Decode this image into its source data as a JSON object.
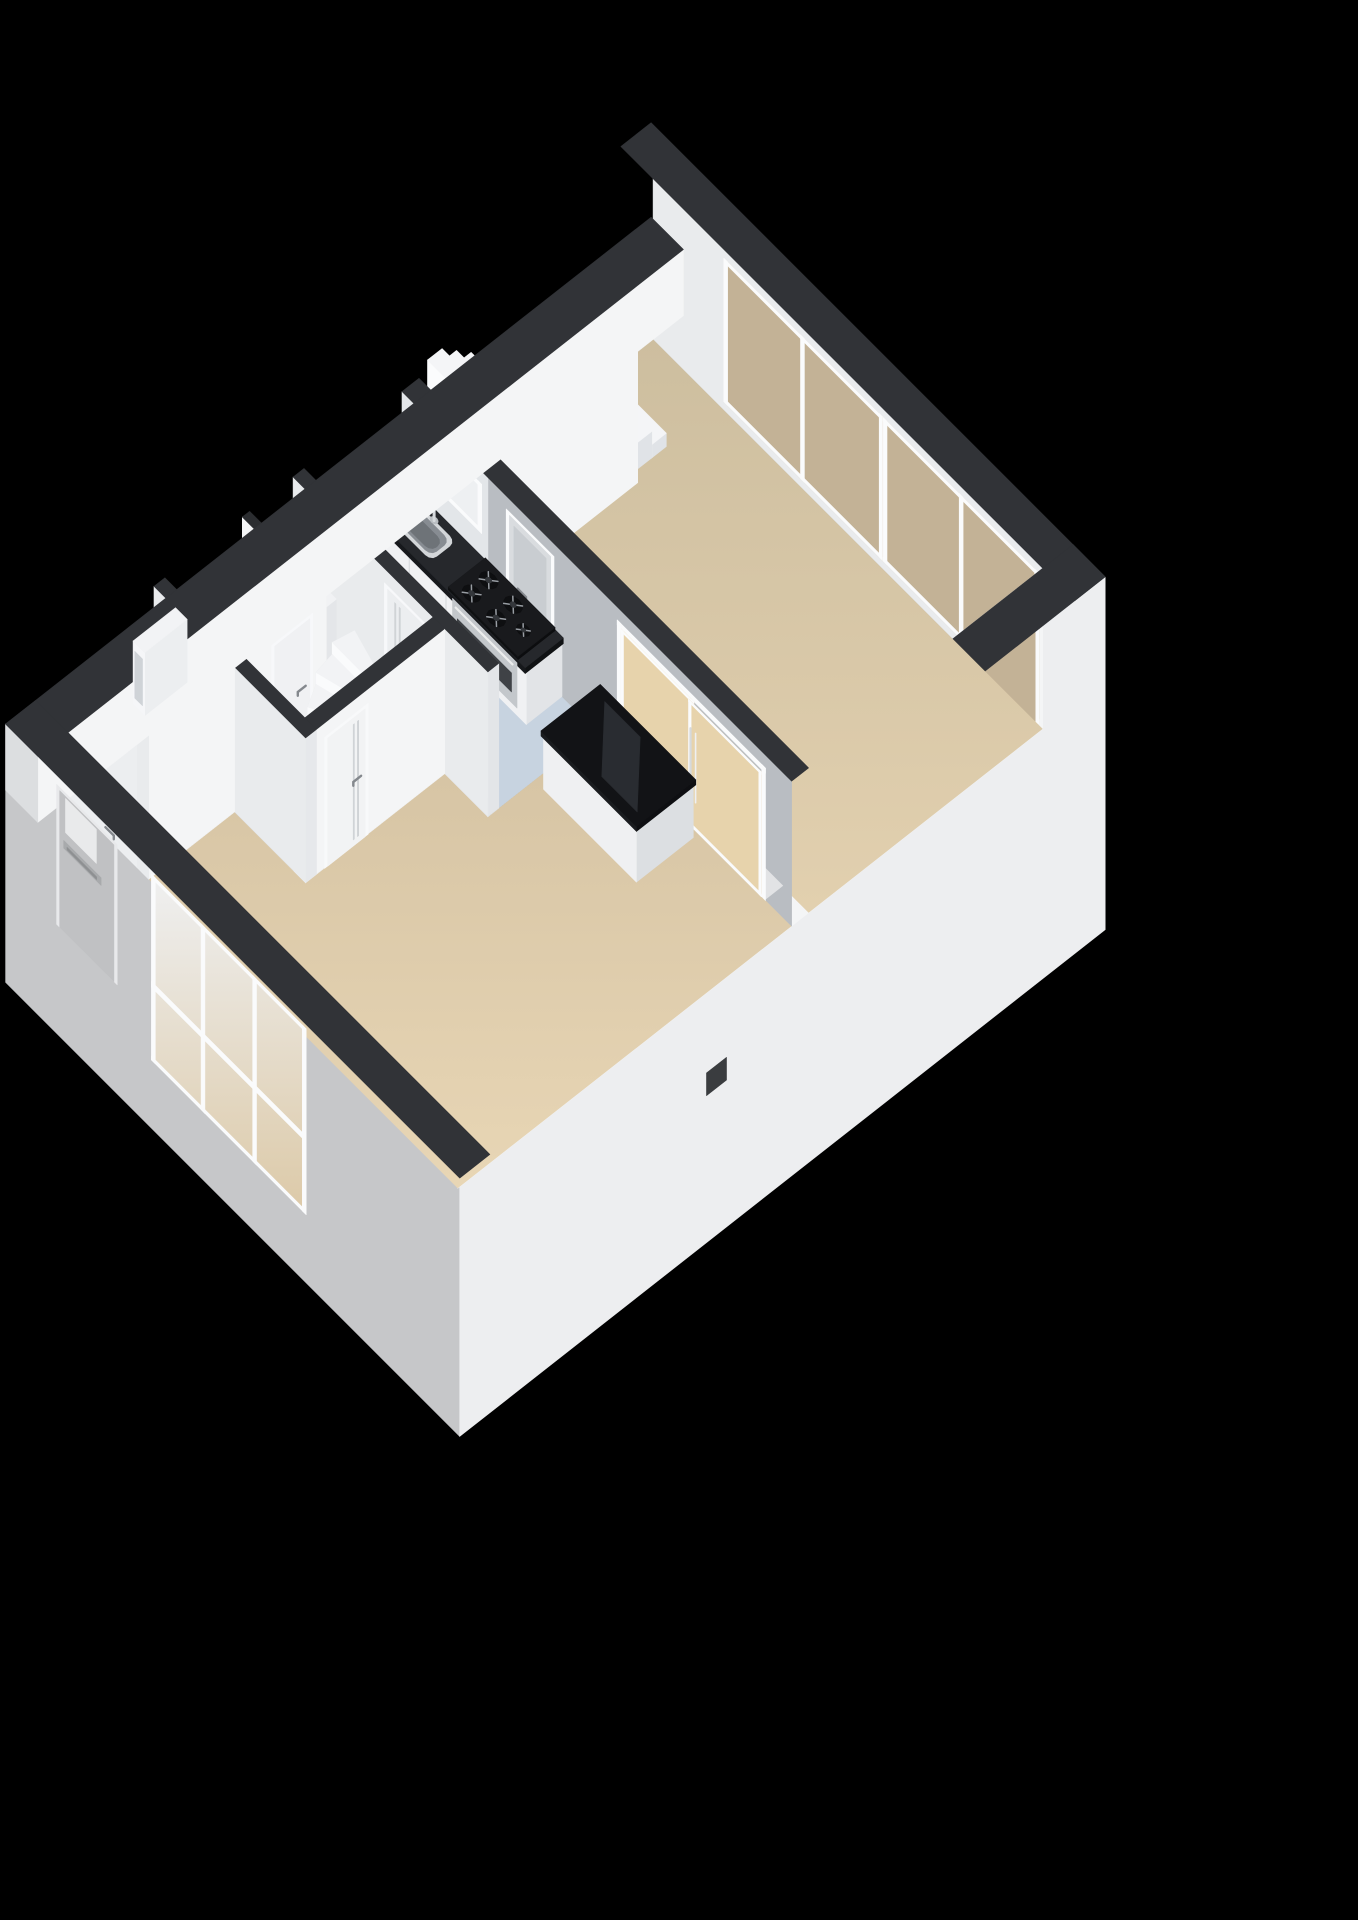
{
  "meta": {
    "kind": "3d-isometric-floorplan-render",
    "level_text": ""
  },
  "canvas": {
    "width": 1358,
    "height": 1920
  },
  "colors": {
    "bg": "#000000",
    "capDark": "#313337",
    "capDark2": "#2b2d30",
    "facadeSW": "#c6c7c9",
    "facadeSE": "#edeef0",
    "wallWhite": "#f4f5f6",
    "wallLight": "#e9ebed",
    "wallGray": "#b9bdc2",
    "wallSoft": "#e3e6e9",
    "floorBlue": "#c7d3e0",
    "floorHall": "#eceef0",
    "floorWC": "#f1f2f4",
    "glassTan": "#c3b296",
    "glassBeige": "#e7d3ac",
    "glassWhite": "#eef0f2",
    "frameWhite": "#fafbfc",
    "counterTop": "#26282c",
    "steel": "#c3c7cb",
    "black": "#121316",
    "chrome": "#d6d9dc",
    "meterAccent": "#c25a2e",
    "floorBeigeDark": "#cfc0a1",
    "floorBeigeLight": "#e5d3b2"
  },
  "projection": {
    "origin": [
      652,
      308
    ],
    "eu": [
      64.5,
      64.5
    ],
    "ev": [
      -60.5,
      47.5
    ],
    "ez": 63
  },
  "gradients": [
    {
      "id": "gBeige1",
      "from": "#cdbe9f",
      "to": "#e2d0af"
    },
    {
      "id": "gBeige2",
      "from": "#d5c3a3",
      "to": "#e8d6b5"
    },
    {
      "id": "gFrontGlass",
      "from": "#eff0f1",
      "to": "#dcc9a7"
    }
  ],
  "scene": [
    {
      "t": "face",
      "name": "facade-sw",
      "plane": "v",
      "c": 10.45,
      "a1": -0.22,
      "a2": 6.82,
      "z1": -3.05,
      "z2": 1.05,
      "fill": "facadeSW"
    },
    {
      "t": "face",
      "name": "facade-se",
      "plane": "u",
      "c": 6.82,
      "a1": -0.22,
      "a2": 10.45,
      "z1": -3.05,
      "z2": 2.55,
      "fill": "facadeSE"
    },
    {
      "t": "face",
      "name": "facade-vent",
      "plane": "u",
      "c": 6.83,
      "a1": 6.05,
      "a2": 6.38,
      "z1": -0.7,
      "z2": -0.34,
      "fill": "#3a3c3f"
    },
    {
      "t": "face",
      "name": "ne-wall-inner",
      "plane": "v",
      "c": 0.28,
      "a1": 0.28,
      "a2": 6.32,
      "z1": 0,
      "z2": 2.55,
      "fill": "wallLight"
    },
    {
      "t": "window",
      "name": "ne-window-left",
      "plane": "v",
      "c": 0.285,
      "a1": 1.38,
      "a2": 3.85,
      "z1": 0.14,
      "z2": 2.42,
      "divs": [
        2.6
      ],
      "rails": [],
      "glass": "glassTan",
      "frame": "frameWhite"
    },
    {
      "t": "window",
      "name": "ne-window-right",
      "plane": "v",
      "c": 0.285,
      "a1": 3.85,
      "a2": 6.26,
      "z1": 0.14,
      "z2": 2.42,
      "divs": [
        5.06
      ],
      "rails": [],
      "glass": "glassTan",
      "frame": "frameWhite"
    },
    {
      "t": "top",
      "name": "ne-wall-cap",
      "u1": -0.22,
      "v1": -0.22,
      "u2": 6.82,
      "v2": 0.28,
      "z": 2.55,
      "fill": "capDark"
    },
    {
      "t": "face",
      "name": "se-wall-inner",
      "plane": "u",
      "c": 6.32,
      "a1": 0.28,
      "a2": 9.95,
      "z1": 0,
      "z2": 2.55,
      "fill": "wallWhite"
    },
    {
      "t": "window",
      "name": "se-window",
      "plane": "u",
      "c": 6.325,
      "a1": 0.34,
      "a2": 2.25,
      "z1": 0.14,
      "z2": 2.42,
      "divs": [
        1.28
      ],
      "rails": [],
      "glass": "glassTan",
      "frame": "frameWhite"
    },
    {
      "t": "top",
      "name": "se-wall-cap",
      "u1": 6.32,
      "v1": -0.22,
      "u2": 6.82,
      "v2": 10.45,
      "z": 2.55,
      "fill": "capDark"
    },
    {
      "t": "floor",
      "name": "floor-living-upper",
      "pts": [
        [
          0.28,
          0.28
        ],
        [
          6.32,
          0.28
        ],
        [
          6.32,
          4.15
        ],
        [
          0.28,
          4.15
        ]
      ],
      "fill": "url:gBeige1"
    },
    {
      "t": "floor",
      "name": "floor-kitchen",
      "pts": [
        [
          0.28,
          4.43
        ],
        [
          3.3,
          4.43
        ],
        [
          3.3,
          6.05
        ],
        [
          0.28,
          6.05
        ]
      ],
      "fill": "floorBlue"
    },
    {
      "t": "floor",
      "name": "floor-living-lower",
      "pts": [
        [
          3.3,
          4.43
        ],
        [
          6.32,
          4.43
        ],
        [
          6.32,
          9.95
        ],
        [
          1.53,
          9.95
        ],
        [
          1.53,
          8.53
        ],
        [
          2.63,
          8.53
        ],
        [
          2.63,
          6.23
        ],
        [
          3.3,
          6.23
        ]
      ],
      "fill": "url:gBeige2"
    },
    {
      "t": "floor",
      "name": "floor-hall",
      "pts": [
        [
          0.28,
          6.23
        ],
        [
          2.45,
          6.23
        ],
        [
          2.45,
          8.35
        ],
        [
          1.35,
          8.35
        ],
        [
          1.35,
          9.95
        ],
        [
          0.28,
          9.95
        ]
      ],
      "fill": "floorHall"
    },
    {
      "t": "floor",
      "name": "floor-toilet",
      "pts": [
        [
          0.28,
          7.07
        ],
        [
          1.35,
          7.07
        ],
        [
          1.35,
          8.35
        ],
        [
          0.28,
          8.35
        ]
      ],
      "fill": "floorWC"
    },
    {
      "t": "stairs",
      "name": "staircase-upper-room",
      "u1": 0.3,
      "u2": 1.3,
      "vBase": 1.15,
      "vTop": 4.03,
      "steps": 12,
      "rise": 0.21,
      "top": "#f4f5f7",
      "riser": "#fbfcfd",
      "side": "#e0e3e7"
    },
    {
      "t": "prism",
      "name": "staircase-side-wall",
      "u1": 1.3,
      "v1": 1.75,
      "u2": 1.42,
      "v2": 4.15,
      "z0": 0,
      "z1": 2.55,
      "ftop": "#eef0f2",
      "fsw": "#e8eaec",
      "fse": "wallWhite"
    },
    {
      "t": "face",
      "name": "wall-a-face-kitchen",
      "plane": "v",
      "c": 4.43,
      "a1": 0.28,
      "a2": 1.62,
      "z1": 0,
      "z2": 2.3,
      "fill": "wallSoft"
    },
    {
      "t": "face",
      "name": "wall-a-face-living",
      "plane": "v",
      "c": 4.43,
      "a1": 1.62,
      "a2": 6.32,
      "z1": 0,
      "z2": 2.3,
      "fill": "wallGray"
    },
    {
      "t": "window",
      "name": "kitchen-window",
      "plane": "v",
      "c": 4.435,
      "a1": 0.86,
      "a2": 1.52,
      "z1": 1.32,
      "z2": 2.1,
      "divs": [],
      "rails": [],
      "glass": "glassWhite",
      "frame": "frameWhite"
    },
    {
      "t": "door",
      "name": "kitchen-door",
      "plane": "v",
      "c": 4.435,
      "a1": 1.9,
      "a2": 2.64,
      "z1": 0,
      "z2": 2.1,
      "panel": "#d9dcdf",
      "frame": "frameWhite",
      "pane": {
        "a1": 2.02,
        "a2": 2.52,
        "z1": 0.95,
        "z2": 1.95,
        "fill": "#c9cdd1"
      },
      "handleAt": 2.08,
      "grooves": false
    },
    {
      "t": "top",
      "name": "sliding-door-threshold",
      "u1": 3.62,
      "v1": 4.15,
      "u2": 5.92,
      "v2": 4.43,
      "z": 0.02,
      "fill": "#e2e3e5"
    },
    {
      "t": "sliding",
      "name": "sliding-doors",
      "plane": "v",
      "c": 4.435,
      "a1": 3.62,
      "a2": 5.92,
      "z1": 0,
      "z2": 2.1,
      "mid": 4.77,
      "glass": "glassBeige",
      "frame": "frameWhite"
    },
    {
      "t": "top",
      "name": "wall-a-cap",
      "u1": 0.28,
      "v1": 4.15,
      "u2": 6.32,
      "v2": 4.43,
      "z": 2.3,
      "fill": "capDark"
    },
    {
      "t": "prism",
      "name": "cabinet-box-body",
      "u1": 3.44,
      "v1": 4.52,
      "u2": 4.88,
      "v2": 5.46,
      "z0": 0,
      "z1": 0.84,
      "ftop": "#eff0f2",
      "fsw": "#eff0f2",
      "fse": "#dcdfe2"
    },
    {
      "t": "prism",
      "name": "cabinet-box-top",
      "u1": 3.42,
      "v1": 4.5,
      "u2": 4.9,
      "v2": 5.48,
      "z0": 0.84,
      "z1": 0.92,
      "ftop": "black",
      "fsw": "#1a1c1f",
      "fse": "#0e0f12"
    },
    {
      "t": "floor3",
      "name": "cabinet-top-sheen",
      "pts": [
        [
          3.6,
          4.62
        ],
        [
          4.15,
          4.62
        ],
        [
          4.78,
          5.34
        ],
        [
          4.23,
          5.34
        ]
      ],
      "z": 0.921,
      "fill": "#292c31"
    },
    {
      "t": "prism",
      "name": "counter-body",
      "u1": 0.3,
      "v1": 4.43,
      "u2": 2.76,
      "v2": 5.02,
      "z0": 0,
      "z1": 0.86,
      "ftop": "#e8eaec",
      "fsw": "#f0f1f3",
      "fse": "#e2e4e7"
    },
    {
      "t": "line3",
      "name": "counter-seam-1",
      "pts": [
        [
          0.95,
          5.025,
          0.06
        ],
        [
          0.95,
          5.025,
          0.8
        ]
      ],
      "color": "#d9dbde",
      "w": 1.2
    },
    {
      "t": "line3",
      "name": "counter-seam-2",
      "pts": [
        [
          1.52,
          5.025,
          0.06
        ],
        [
          1.52,
          5.025,
          0.8
        ]
      ],
      "color": "#d9dbde",
      "w": 1.2
    },
    {
      "t": "prism",
      "name": "counter-worktop",
      "u1": 0.3,
      "v1": 4.43,
      "u2": 2.78,
      "v2": 5.06,
      "z0": 0.86,
      "z1": 0.95,
      "ftop": "counterTop",
      "fsw": "#17191c",
      "fse": "#101214"
    },
    {
      "t": "sink",
      "name": "kitchen-sink",
      "cu": 0.88,
      "cv": 4.74,
      "ru": 0.33,
      "rv": 0.2,
      "z": 0.952,
      "rim": "#d3d6d9",
      "basin": "#878c92",
      "inner": "#6e7378"
    },
    {
      "t": "faucet",
      "name": "kitchen-faucet",
      "u": 0.88,
      "v": 4.54,
      "z0": 0.95,
      "z1": 1.33,
      "spout": 0.17,
      "color": "chrome"
    },
    {
      "t": "prism",
      "name": "stove-cooktop",
      "u1": 1.58,
      "v1": 4.44,
      "u2": 2.66,
      "v2": 5.05,
      "z0": 0.95,
      "z1": 1.0,
      "ftop": "#191a1d",
      "fsw": "#0f1012",
      "fse": "#0c0d0f"
    },
    {
      "t": "burner",
      "name": "stove-burner-1",
      "cu": 1.8,
      "cv": 4.62,
      "r": 0.115
    },
    {
      "t": "burner",
      "name": "stove-burner-2",
      "cu": 1.8,
      "cv": 4.9,
      "r": 0.115
    },
    {
      "t": "burner",
      "name": "stove-burner-3",
      "cu": 2.18,
      "cv": 4.62,
      "r": 0.115
    },
    {
      "t": "burner",
      "name": "stove-burner-4",
      "cu": 2.18,
      "cv": 4.9,
      "r": 0.115
    },
    {
      "t": "burner",
      "name": "stove-burner-5",
      "cu": 2.47,
      "cv": 4.76,
      "r": 0.085
    },
    {
      "t": "face",
      "name": "oven-front",
      "plane": "v",
      "c": 5.025,
      "a1": 1.62,
      "a2": 2.62,
      "z1": 0.12,
      "z2": 0.84,
      "fill": "steel"
    },
    {
      "t": "face",
      "name": "oven-window",
      "plane": "v",
      "c": 5.03,
      "a1": 1.7,
      "a2": 2.54,
      "z1": 0.3,
      "z2": 0.6,
      "fill": "#3f4246"
    },
    {
      "t": "line3",
      "name": "oven-handle",
      "pts": [
        [
          1.68,
          5.035,
          0.76
        ],
        [
          2.56,
          5.035,
          0.76
        ]
      ],
      "color": "#eceded",
      "w": 2.2
    },
    {
      "t": "prism",
      "name": "kitchen-partition",
      "u1": 0.28,
      "v1": 5.5,
      "u2": 2.4,
      "v2": 5.6,
      "z0": 0,
      "z1": 1.05,
      "ftop": "capDark2",
      "fsw": "#e6e8ea",
      "fse": "#dde0e3"
    },
    {
      "t": "prism",
      "name": "wall-hall-kitchen",
      "u1": 0.28,
      "v1": 6.05,
      "u2": 3.3,
      "v2": 6.23,
      "z0": 0,
      "z1": 2.3,
      "ftop": "capDark",
      "fsw": "wallLight",
      "fse": "#e3e5e8"
    },
    {
      "t": "door",
      "name": "hall-kitchen-door",
      "plane": "v",
      "c": 6.235,
      "a1": 1.7,
      "a2": 2.38,
      "z1": 0,
      "z2": 2.08,
      "panel": "#eceef0",
      "frame": "#f7f8fa",
      "pane": null,
      "handleAt": 2.26,
      "grooves": true
    },
    {
      "t": "prism",
      "name": "meter-closet",
      "u1": 0.28,
      "v1": 6.23,
      "u2": 0.95,
      "v2": 6.95,
      "z0": 0,
      "z1": 1.05,
      "ftop": "#f1f2f4",
      "fsw": "#eef0f2",
      "fse": "#e4e6e9"
    },
    {
      "t": "meters",
      "name": "meter-marks",
      "u0": 0.4,
      "v": 6.42,
      "z": 1.05,
      "count": 4,
      "accentIndex": 2
    },
    {
      "t": "prism",
      "name": "toilet-wall-n",
      "u1": 0.28,
      "v1": 6.95,
      "u2": 1.47,
      "v2": 7.07,
      "z0": 0,
      "z1": 2.3,
      "ftop": "capDark2",
      "fsw": "wallWhite",
      "fse": "#e8eaec"
    },
    {
      "t": "prism",
      "name": "toilet-wall-e",
      "u1": 1.35,
      "v1": 6.95,
      "u2": 1.47,
      "v2": 8.35,
      "z0": 0,
      "z1": 2.3,
      "ftop": "capDark2",
      "fsw": "#eceef0",
      "fse": "wallWhite"
    },
    {
      "t": "door",
      "name": "toilet-door",
      "plane": "u",
      "c": 1.475,
      "a1": 7.18,
      "a2": 7.86,
      "z1": 0,
      "z2": 2.08,
      "panel": "#f0f1f3",
      "frame": "#f7f8fa",
      "pane": null,
      "handleAt": 7.3,
      "grooves": false
    },
    {
      "t": "prism",
      "name": "toilet-hand-basin",
      "u1": 0.34,
      "v1": 7.98,
      "u2": 0.62,
      "v2": 8.28,
      "z0": 0,
      "z1": 0.55,
      "ftop": "#eef0f2",
      "fsw": "#f4f5f7",
      "fse": "#e6e8eb"
    },
    {
      "t": "disk",
      "name": "toilet-basin-bowl",
      "cu": 0.48,
      "cv": 8.13,
      "r": 0.1,
      "z": 0.555,
      "fill": "#d7dbde"
    },
    {
      "t": "winder",
      "name": "staircase-hall-winder",
      "pivot": [
        2.36,
        6.7
      ],
      "r1": 0.14,
      "r2": 1.04,
      "a0": 92,
      "a1": 198,
      "steps": 6,
      "z0": 0.14,
      "rise": 0.19,
      "top": "#f2f3f5",
      "riser": "#fafbfc",
      "side": "#e0e3e6"
    },
    {
      "t": "prism",
      "name": "winder-newel",
      "u1": 2.3,
      "v1": 6.64,
      "u2": 2.42,
      "v2": 6.76,
      "z0": 0,
      "z1": 1.45,
      "ftop": "#eef0f2",
      "fsw": "#f2f3f4",
      "fse": "#e5e7ea"
    },
    {
      "t": "prism",
      "name": "wall-hall-living",
      "u1": 2.45,
      "v1": 6.23,
      "u2": 2.63,
      "v2": 8.53,
      "z0": 0,
      "z1": 2.3,
      "ftop": "capDark",
      "fsw": "#eceef0",
      "fse": "wallWhite"
    },
    {
      "t": "door",
      "name": "hall-living-door",
      "plane": "u",
      "c": 2.635,
      "a1": 7.5,
      "a2": 8.22,
      "z1": 0,
      "z2": 2.08,
      "panel": "#f2f3f4",
      "frame": "#f8f9fa",
      "pane": null,
      "handleAt": 7.62,
      "grooves": true
    },
    {
      "t": "prism",
      "name": "wall-hall-sw",
      "u1": 0.28,
      "v1": 8.35,
      "u2": 2.63,
      "v2": 8.53,
      "z0": 0,
      "z1": 2.3,
      "ftop": "capDark",
      "fsw": "wallLight",
      "fse": "#e6e8eb"
    },
    {
      "t": "prism",
      "name": "wall-corridor",
      "u1": 1.35,
      "v1": 8.53,
      "u2": 1.53,
      "v2": 9.95,
      "z0": 0,
      "z1": 2.3,
      "ftop": "capDark",
      "fsw": "#e9ebed",
      "fse": "wallWhite"
    },
    {
      "t": "prism",
      "name": "nw-wall",
      "u1": -0.22,
      "v1": -0.22,
      "u2": 0.28,
      "v2": 10.45,
      "z0": 0,
      "z1": 1.05,
      "ftop": "capDark",
      "fsw": "#dcdee0",
      "fse": "wallWhite"
    },
    {
      "t": "prism",
      "name": "toilet-ext-window-box",
      "u1": -0.4,
      "v1": 7.45,
      "u2": -0.22,
      "v2": 8.15,
      "z0": -0.55,
      "z1": 0.45,
      "ftop": "#f2f3f5",
      "fsw": "#f5f6f8",
      "fse": "#eceef0"
    },
    {
      "t": "face",
      "name": "toilet-ext-window-glass",
      "plane": "v",
      "c": 8.155,
      "a1": -0.37,
      "a2": -0.25,
      "z1": -0.42,
      "z2": 0.32,
      "fill": "#cfd3d7"
    },
    {
      "t": "top",
      "name": "sw-wall-cap",
      "u1": -0.22,
      "v1": 9.95,
      "u2": 6.82,
      "v2": 10.45,
      "z": 1.05,
      "fill": "capDark"
    },
    {
      "t": "window",
      "name": "front-window",
      "plane": "v",
      "c": 10.46,
      "a1": 2.05,
      "a2": 4.45,
      "z1": -1.95,
      "z2": 1.0,
      "divs": [
        2.85,
        3.65
      ],
      "rails": [
        -0.75
      ],
      "glass": "url:gFrontGlass",
      "frame": "frameWhite"
    },
    {
      "t": "door",
      "name": "front-door",
      "plane": "v",
      "c": 10.46,
      "a1": 0.58,
      "a2": 1.52,
      "z1": -1.3,
      "z2": 0.92,
      "panel": "#c0c1c3",
      "frame": "#e8e9eb",
      "pane": {
        "a1": 0.72,
        "a2": 1.2,
        "z1": 0.3,
        "z2": 0.84,
        "fill": "#e9eaeb"
      },
      "handleAt": 1.34,
      "grooves": false
    },
    {
      "t": "face",
      "name": "front-door-letterbox",
      "plane": "v",
      "c": 10.47,
      "a1": 0.7,
      "a2": 1.28,
      "z1": 0.04,
      "z2": 0.16,
      "fill": "#a8aaac"
    },
    {
      "t": "face",
      "name": "front-door-letterbox-slot",
      "plane": "v",
      "c": 10.48,
      "a1": 0.76,
      "a2": 1.22,
      "z1": 0.08,
      "z2": 0.12,
      "fill": "#8e9092"
    }
  ]
}
